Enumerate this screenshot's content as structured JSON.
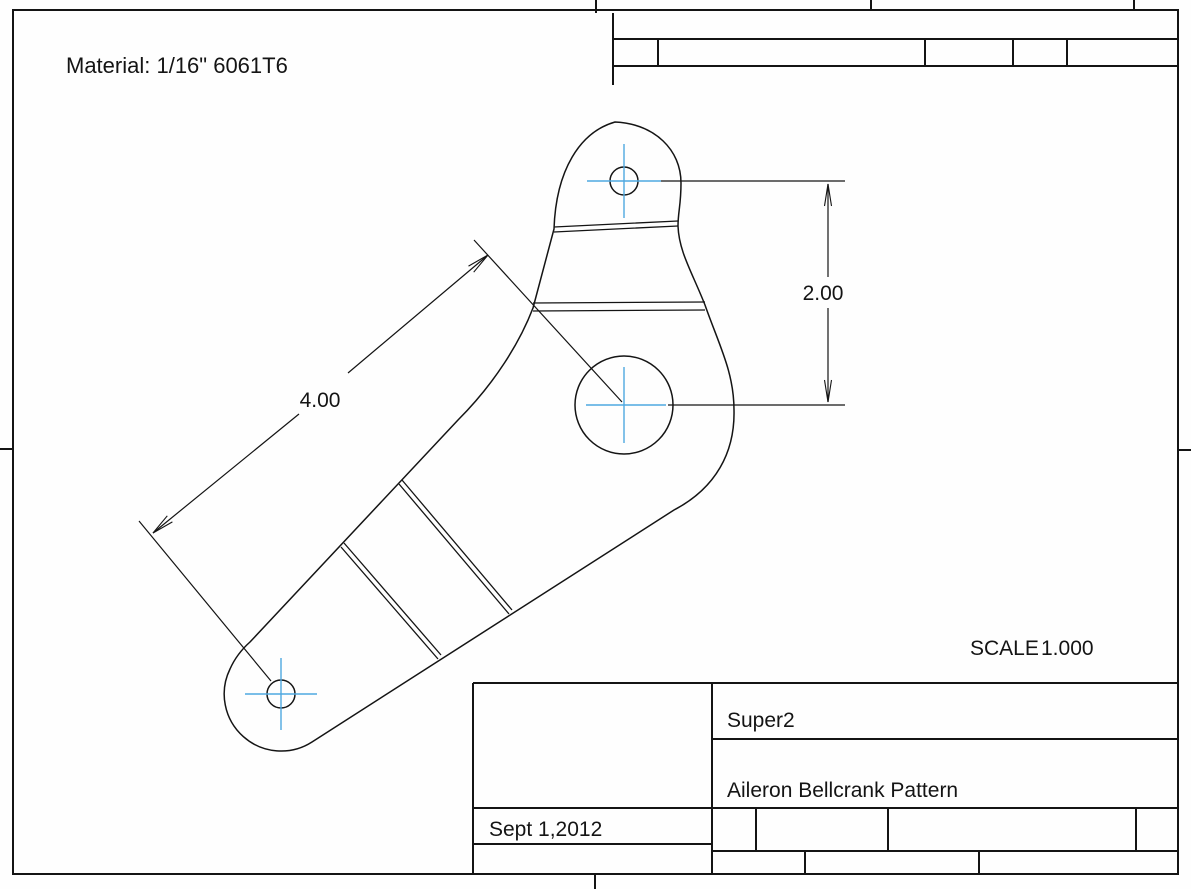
{
  "sheet": {
    "material_note": "Material: 1/16\" 6061T6",
    "scale": {
      "label": "SCALE",
      "value": "1.000"
    },
    "title_block": {
      "project": "Super2",
      "drawing_title": "Aileron Bellcrank Pattern",
      "date": "Sept 1,2012"
    },
    "dimensions": {
      "hole_spacing_vertical": "2.00",
      "hole_spacing_diagonal": "4.00"
    },
    "colors": {
      "line": "#141414",
      "centerline": "#4fa8e0",
      "paper": "#fefefe"
    }
  }
}
